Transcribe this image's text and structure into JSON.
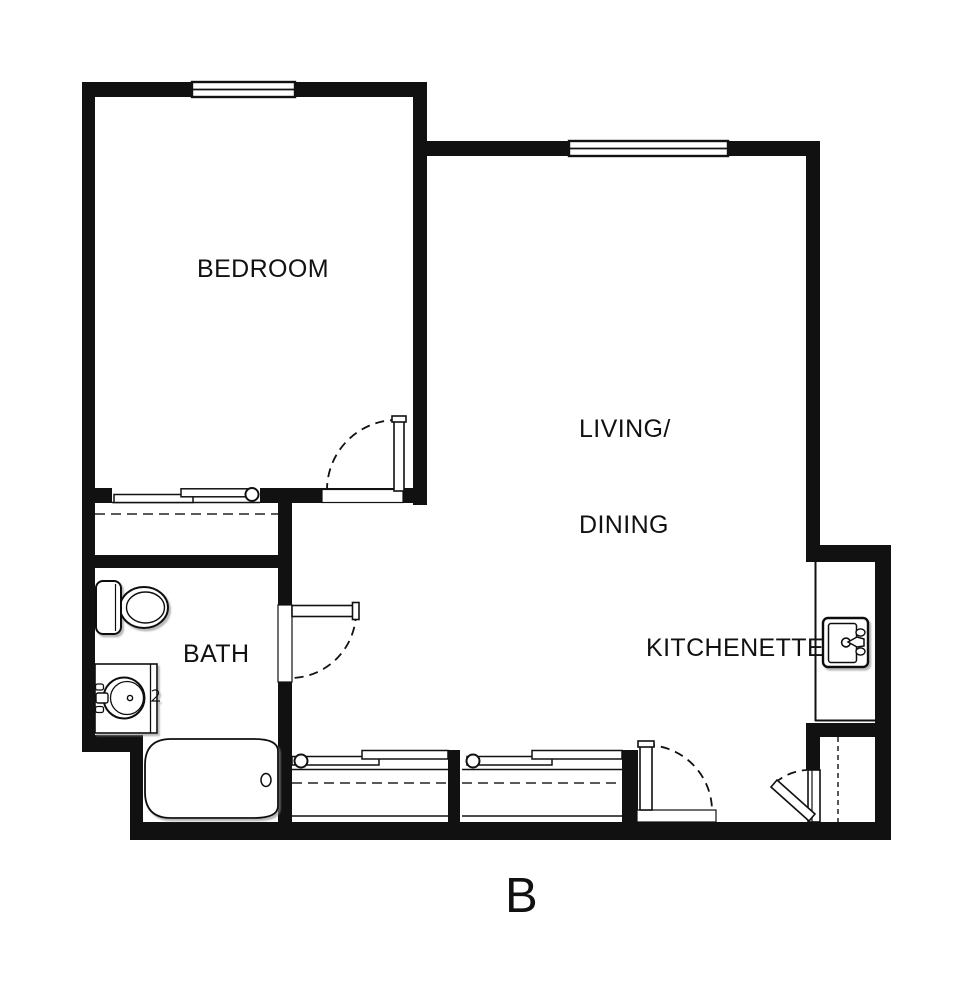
{
  "plan": {
    "title": "B"
  },
  "colors": {
    "wall": "#111111",
    "background": "#ffffff",
    "line": "#111111",
    "fixture_shadow": "#8a8a8a"
  },
  "rooms": {
    "bedroom": {
      "label": "BEDROOM"
    },
    "living_dining": {
      "label_line1": "LIVING/",
      "label_line2": "DINING"
    },
    "bath": {
      "label": "BATH"
    },
    "kitchenette": {
      "label": "KITCHENETTE"
    }
  },
  "fixtures": [
    {
      "name": "toilet",
      "room": "bath"
    },
    {
      "name": "vanity-sink",
      "room": "bath"
    },
    {
      "name": "bathtub",
      "room": "bath"
    },
    {
      "name": "kitchen-sink",
      "room": "kitchenette"
    },
    {
      "name": "kitchen-counter",
      "room": "kitchenette"
    }
  ],
  "doors": [
    {
      "name": "bedroom-door",
      "type": "hinged-swing"
    },
    {
      "name": "bath-door",
      "type": "hinged-swing"
    },
    {
      "name": "entry-door",
      "type": "hinged-swing"
    },
    {
      "name": "entry-closet-door",
      "type": "hinged-swing"
    }
  ],
  "windows": [
    {
      "name": "bedroom-window",
      "wall": "top"
    },
    {
      "name": "living-dining-window",
      "wall": "top"
    }
  ],
  "closets": [
    {
      "name": "bedroom-closet",
      "door": "sliding-bypass",
      "feature": "closet-rod"
    },
    {
      "name": "hall-closet-1",
      "door": "sliding-bypass",
      "feature": "closet-rod-and-shelf"
    },
    {
      "name": "hall-closet-2",
      "door": "sliding-bypass",
      "feature": "closet-rod-and-shelf"
    },
    {
      "name": "entry-closet",
      "door": "hinged",
      "feature": "shelf-line"
    }
  ]
}
